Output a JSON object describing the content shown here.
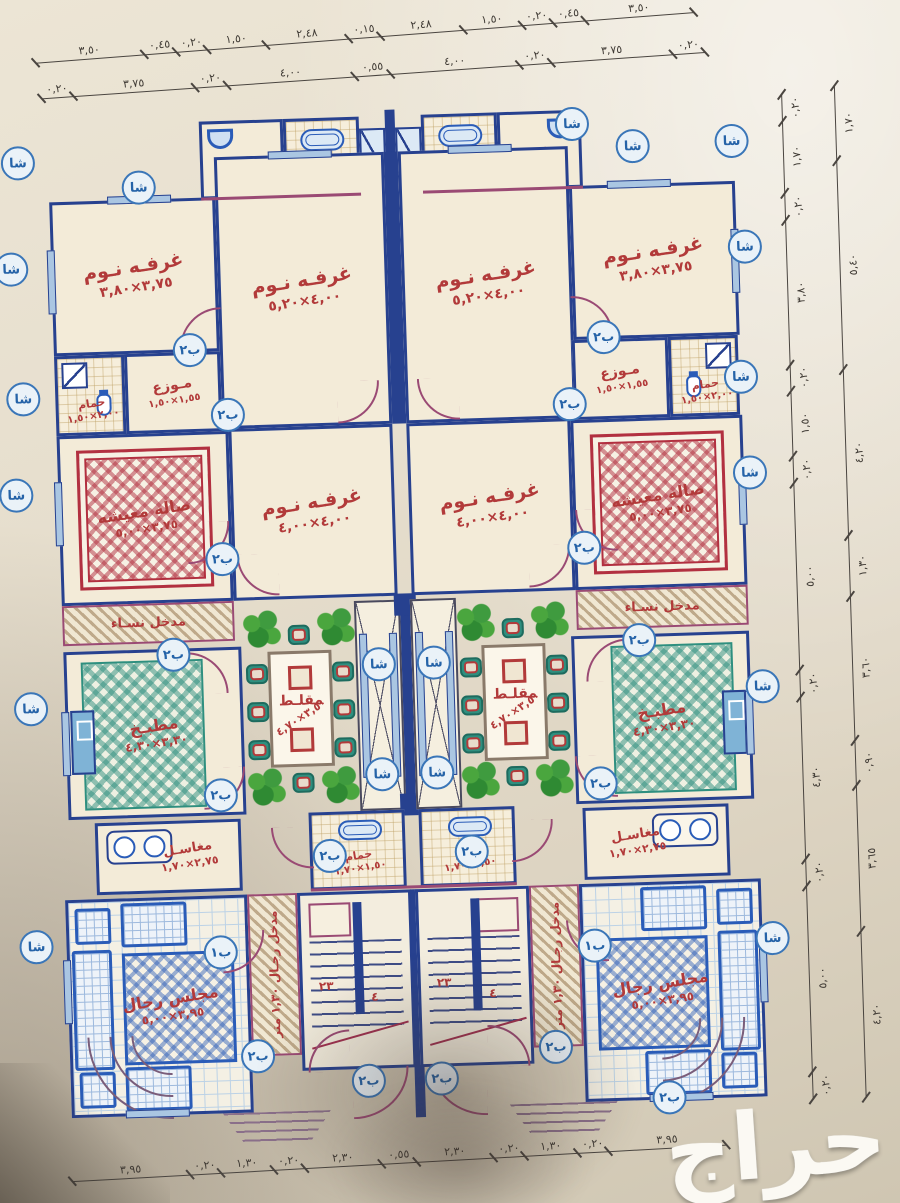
{
  "sheet": {
    "watermark": "حراج"
  },
  "rooms": {
    "bedroom_s": {
      "label": "غرفـه نـوم",
      "dims": "٣,٧٥×٣,٨٠"
    },
    "bedroom_l": {
      "label": "غرفـه نـوم",
      "dims": "٤,٠٠×٥,٢٠"
    },
    "bedroom_m": {
      "label": "غرفـه نـوم",
      "dims": "٤,٠٠×٤,٠٠"
    },
    "living": {
      "label": "صاله معيشه",
      "dims": "٣,٧٥×٥,٠٠"
    },
    "kitchen": {
      "label": "مطبـخ",
      "dims": "٣,٣٠×٤,٣٠"
    },
    "dining": {
      "label": "مقلـط",
      "dims": "٣,٥٠×٤,٧٠"
    },
    "majlis": {
      "label": "مجلس رجال",
      "dims": "٣,٩٥×٥,٠٠"
    },
    "sinks_top": {
      "label": "مغاسـل",
      "dims": "٢,٠٠×١,٥٠"
    },
    "bath": {
      "label": "حمام",
      "dims": "٢,٠٠×١,٥٠"
    },
    "distributor": {
      "label": "مـوزع",
      "dims": "١,٥٥×١,٥٠"
    },
    "sinks_low": {
      "label": "مغاسـل",
      "dims": "٢,٧٥×١,٧٠"
    },
    "bath_low": {
      "label": "حمام",
      "dims": "١,٥٠×١,٧٠"
    },
    "women_entry": {
      "label": "مدخل نسـاء"
    },
    "men_entry": {
      "label": "مدخل رجـال ١,٣٠ متر"
    }
  },
  "stairs": {
    "count_a": "٢٣",
    "count_b": "٤"
  },
  "markers": {
    "sha": "شا",
    "b1": "ب١",
    "b2": "ب٢"
  },
  "dimensions": {
    "top_row1": [
      "٣,٥٠",
      "٠,٤٥",
      "٠,٢٠",
      "١,٥٠",
      "٢,٤٨",
      "٠,١٥",
      "٢,٤٨",
      "١,٥٠",
      "٠,٢٠",
      "٠,٤٥",
      "٣,٥٠"
    ],
    "top_row2": [
      "٠,٢٠",
      "٣,٧٥",
      "٠,٢٠",
      "٤,٠٠",
      "٠,٥٥",
      "٤,٠٠",
      "٠,٢٠",
      "٣,٧٥",
      "٠,٢٠"
    ],
    "right_col1": [
      "٠,٢٠",
      "١,٧٠",
      "٠,٢٠",
      "٣,٨٠",
      "٠,٢٠",
      "١,٥٠",
      "٠,٢٠",
      "٥,٠٠",
      "٠,٢٠",
      "٤,٣٠",
      "٠,٢٠",
      "٥,٠٠",
      "٠,٢٠"
    ],
    "right_col2": [
      "١,٧٠",
      "٥,٤٠",
      "٤,٢٠",
      "١,٣٠",
      "٣,٦٠",
      "٠,٩٠",
      "٣,٦٥",
      "٤,٢٠"
    ],
    "bottom_row": [
      "٣,٩٥",
      "٠,٢٠",
      "١,٣٠",
      "٠,٢٠",
      "٢,٣٠",
      "٠,٥٥",
      "٢,٣٠",
      "٠,٢٠",
      "١,٣٠",
      "٠,٢٠",
      "٣,٩٥"
    ]
  }
}
